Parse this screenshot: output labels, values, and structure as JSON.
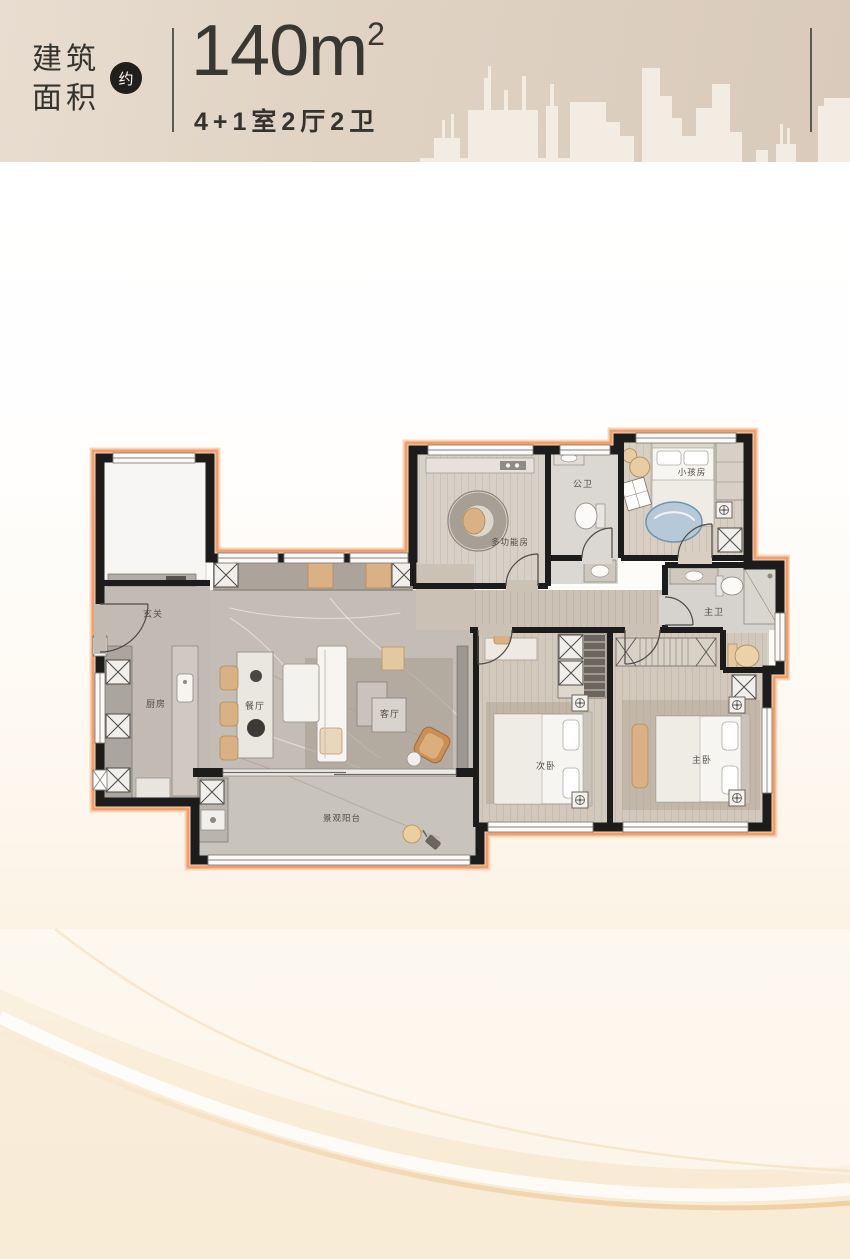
{
  "header": {
    "area_label_line1": "建筑",
    "area_label_line2": "面积",
    "approx_badge": "约",
    "area_value": "140m",
    "area_superscript": "2",
    "layout_spec": "4+1室2厅2卫"
  },
  "floorplan": {
    "rooms": {
      "foyer": {
        "label": "玄关"
      },
      "kitchen": {
        "label": "厨房"
      },
      "dining": {
        "label": "餐厅"
      },
      "living": {
        "label": "客厅"
      },
      "multi_function": {
        "label": "多功能房"
      },
      "public_bath": {
        "label": "公卫"
      },
      "kids_room": {
        "label": "小孩房"
      },
      "master_bath": {
        "label": "主卫"
      },
      "second_bedroom": {
        "label": "次卧"
      },
      "master_bedroom": {
        "label": "主卧"
      },
      "balcony": {
        "label": "景观阳台"
      }
    },
    "colors": {
      "outline": "#ef9e6c",
      "outline_halo": "#f8cfae",
      "wall": "#1c1c1c",
      "marble_floor": "#c1bbb4",
      "wood_floor": "#d2c9bc",
      "accent_tan": "#d9b184"
    }
  },
  "theme": {
    "header_background": "#ddcfc0",
    "header_text": "#34332e",
    "badge_background": "#201f1c",
    "page_cream": "#f9edda"
  }
}
